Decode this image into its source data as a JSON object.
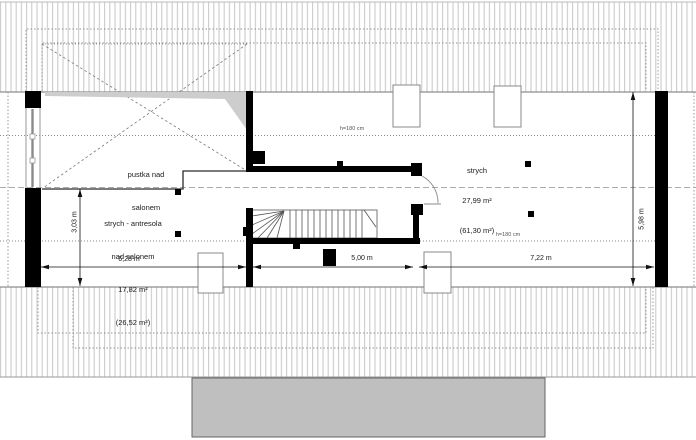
{
  "drawing": {
    "type": "attic-floor-plan",
    "labels": {
      "pustka_line1": "pustka nad",
      "pustka_line2": "salonem",
      "antresola_line1": "strych - antresola",
      "antresola_line2": "nad salonem",
      "antresola_area": "17,82 m²",
      "antresola_area_total": "(26,52 m²)",
      "strych_name": "strych",
      "strych_area": "27,99 m²",
      "strych_area_total": "(61,30 m²)"
    },
    "height_notes": {
      "top": "h=180 cm",
      "bottom": "h=180 cm"
    },
    "dimensions": {
      "bottom_left": "6,28 m",
      "bottom_middle": "5,00 m",
      "bottom_right": "7,22 m",
      "side_left": "3,03 m",
      "side_right": "5,98 m"
    },
    "colors": {
      "wall": "#000000",
      "roof_hatch": "#c6c6c6",
      "slab_fill": "#bfbfbf",
      "shade_wedge": "#cdcdcd"
    }
  }
}
